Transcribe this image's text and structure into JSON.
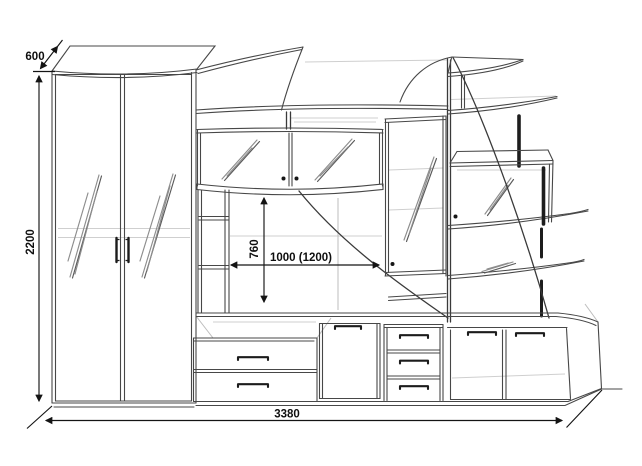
{
  "diagram": {
    "type": "furniture-technical-drawing",
    "subject": "living-room wall unit: mirrored wardrobe, glass upper cabinet, TV niche, curved open shelving tower and base drawer cabinets",
    "colors": {
      "background": "#ffffff",
      "line": "#474747",
      "faint_line": "#cfcfcf",
      "dimension": "#141414"
    },
    "dimensions": {
      "wardrobe_depth": "600",
      "overall_height": "2200",
      "tv_niche_height": "760",
      "tv_niche_width": "1000 (1200)",
      "overall_width": "3380"
    }
  }
}
